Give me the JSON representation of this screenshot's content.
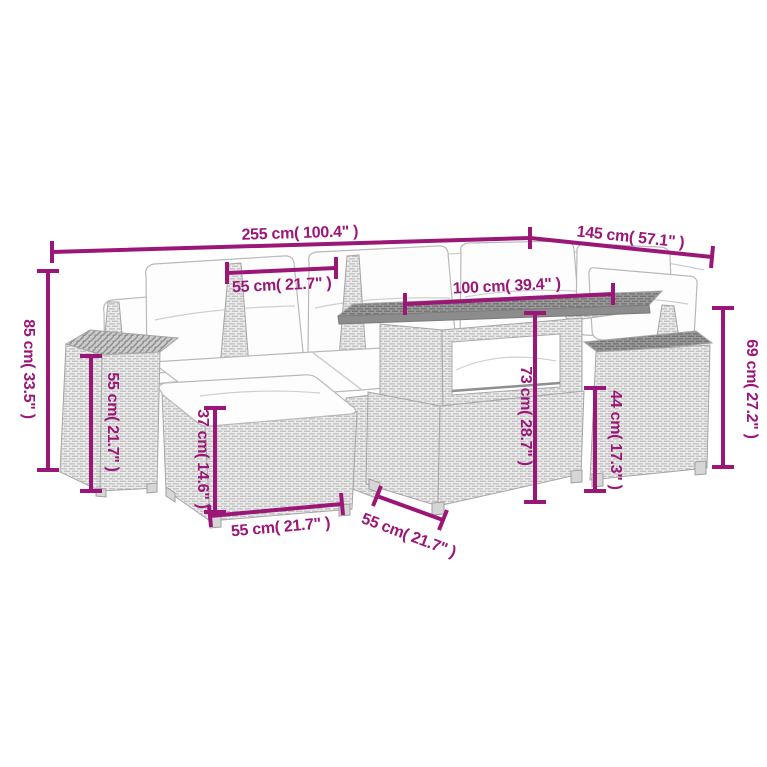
{
  "figure": {
    "background": "#ffffff",
    "subject": "garden-lounge-set-dimension-diagram"
  },
  "colors": {
    "dimension_accent": "#9b1777",
    "wicker_light_fill": "#ebebeb",
    "wicker_light_line": "#c2c2c2",
    "wicker_dark_fill": "#9a9a9a",
    "wicker_dark_line": "#747474",
    "outline": "#a6a6a6",
    "cushion": "#fdfdfd"
  },
  "dimensions": {
    "overall_width": {
      "label": "255 cm( 100.4\" )"
    },
    "right_depth": {
      "label": "145 cm( 57.1\" )"
    },
    "backrest_width": {
      "label": "55 cm( 21.7\" )"
    },
    "table_length": {
      "label": "100 cm( 39.4\" )"
    },
    "overall_height": {
      "label": "85 cm( 33.5\" )"
    },
    "armrest_height": {
      "label": "55 cm( 21.7\" )"
    },
    "ottoman_height": {
      "label": "37 cm( 14.6\" )"
    },
    "ottoman_width": {
      "label": "55 cm( 21.7\" )"
    },
    "table_depth": {
      "label": "55 cm( 21.7\" )"
    },
    "table_height": {
      "label": "73 cm( 28.7\" )"
    },
    "seat_height": {
      "label": "44 cm( 17.3\" )"
    },
    "armrest_total_height": {
      "label": "69 cm( 27.2\" )"
    }
  }
}
